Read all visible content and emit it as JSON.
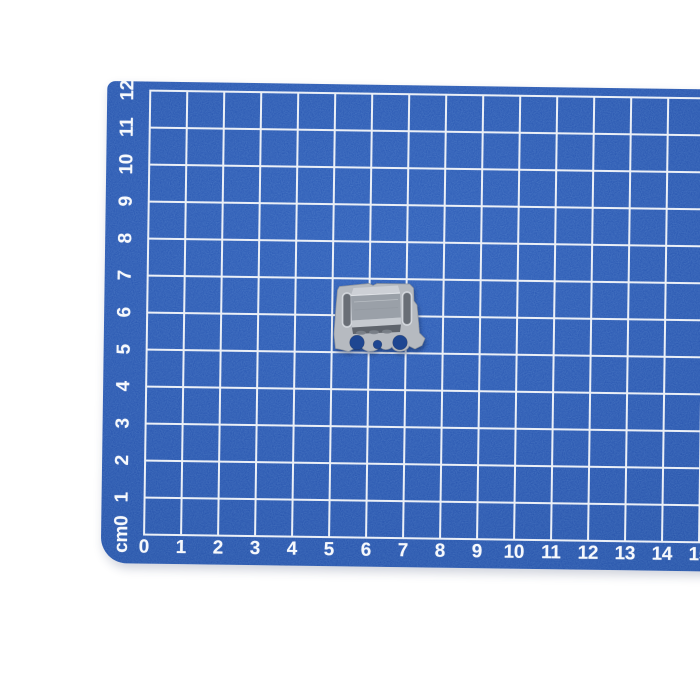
{
  "photo": {
    "subject": "Small galvanized metal mounting clip lying on a blue self-healing cutting mat with a 1 cm white grid"
  },
  "colors": {
    "page_bg": "#ffffff",
    "mat_blue": "#2b58b0",
    "mat_blue_light": "#3161bb",
    "mat_blue_deep": "#24509f",
    "grid_line": "#e9eef6",
    "axis_label": "#f5f8fc",
    "hole_blue": "#1e4691",
    "plate_silver": "#b6bac0",
    "plate_silver_light": "#d3d6db",
    "plate_edge": "#8d939c",
    "slot_dark": "#696e76",
    "box_top": "#cdd0d6",
    "box_face": "#9aa0a8",
    "box_band": "#c6cad0",
    "box_bottom": "#5f646c"
  },
  "mat": {
    "unit": "cm",
    "bottom_axis": {
      "labels": [
        "0",
        "1",
        "2",
        "3",
        "4",
        "5",
        "6",
        "7",
        "8",
        "9",
        "10",
        "11",
        "12",
        "13",
        "14",
        "15"
      ]
    },
    "left_axis": {
      "labels": [
        "cm0",
        "1",
        "2",
        "3",
        "4",
        "5",
        "6",
        "7",
        "8",
        "9",
        "10",
        "11",
        "12"
      ]
    }
  },
  "object": {
    "name": "metal clip",
    "position_cm": "spans roughly 5 to 7.5 cm horizontally and 5 to 7 cm vertically"
  }
}
